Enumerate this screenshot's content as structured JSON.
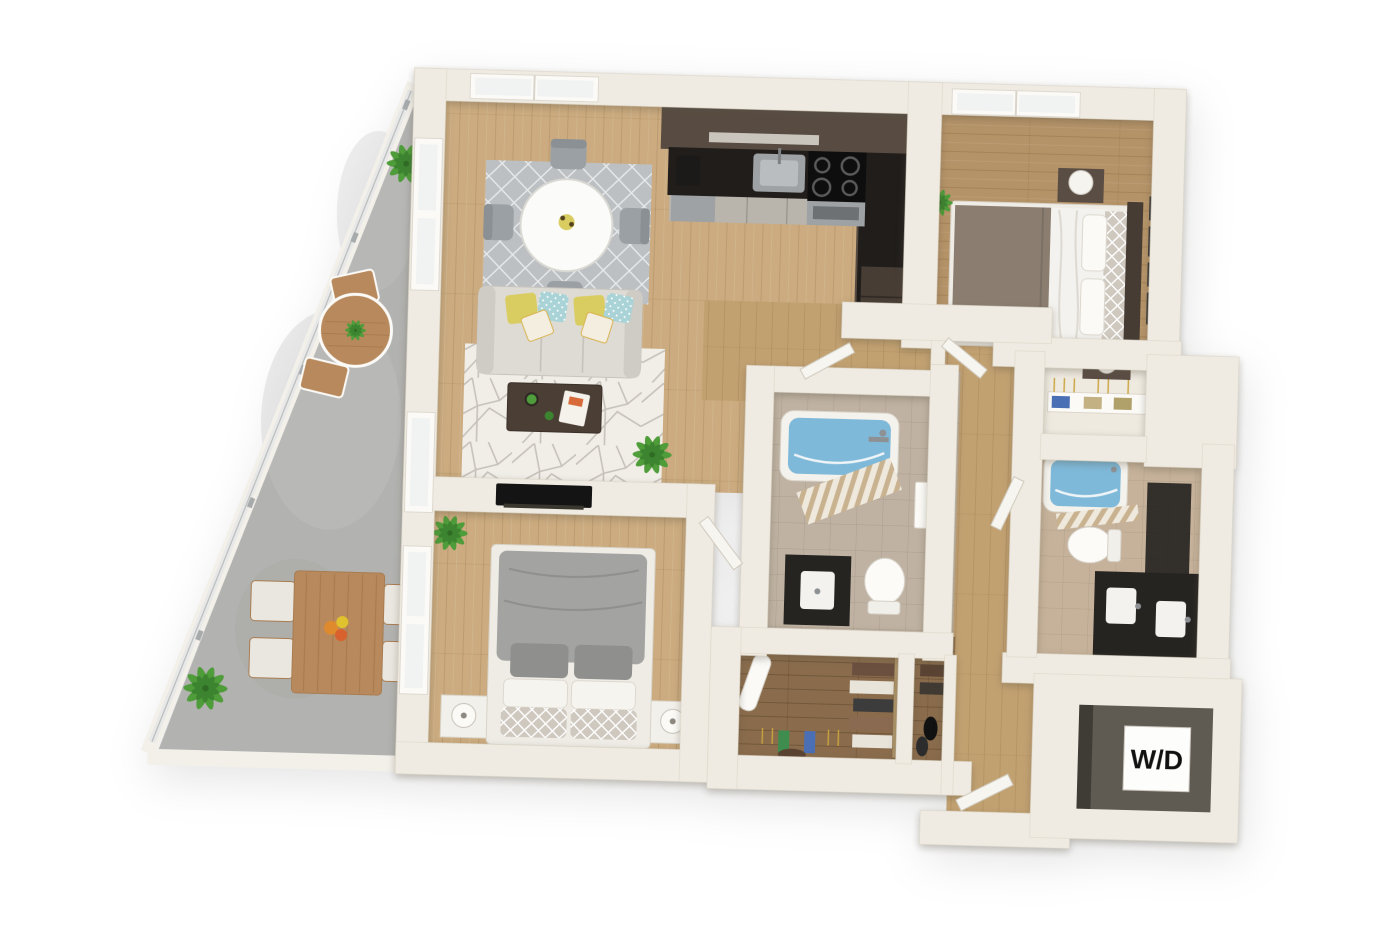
{
  "labels": {
    "washer_dryer": "W/D"
  },
  "colors": {
    "wall": "#f0ebe2",
    "wall_edge": "#ddd6c9",
    "wall_shade": "#d9d2c4",
    "door": "#f7f5f0",
    "floor_wood": "#cbab7f",
    "floor_wood_dark": "#b59368",
    "floor_hall": "#c2a171",
    "floor_closet": "#8a6c4c",
    "concrete": "#b2b2b0",
    "concrete_light": "#c4c4c2",
    "glass": "#e6e8e7",
    "tile1": "#bfb2a2",
    "tile2": "#c6b29a",
    "tub_blue": "#7fb9d9",
    "tub_blue_deep": "#5f9fc4",
    "cabinet_dark": "#584c42",
    "counter_black": "#201d1b",
    "cabinet_front": "#b9b4ac",
    "steel": "#9ea2a5",
    "vanity_dark": "#262421",
    "rug_gray": "#bcc0c3",
    "rug_white": "#f1eee8",
    "rug_line": "#c6c2ba",
    "sofa": "#dedbd4",
    "sofa_dark": "#cfccc5",
    "pillow_yellow": "#d9cd62",
    "pillow_teal": "#a9d3d6",
    "pillow_accent": "#f3eee0",
    "table_white": "#fbfbf9",
    "chair_gray": "#9aa0a4",
    "coffee_table": "#4a3e35",
    "tv_black": "#141414",
    "bed_gray": "#a3a3a1",
    "bed_gray_dark": "#8f8f8d",
    "bed_taupe": "#8b7e71",
    "sheet_white": "#f4f2ee",
    "headboard": "#463c33",
    "nightstand": "#f2f0ea",
    "nightstand_dark": "#5a4d44",
    "outdoor_wood": "#b8895c",
    "outdoor_wood_dark": "#a87c50",
    "cushion": "#eae7e0",
    "plant_green": "#4f9c3a",
    "plant_green_dark": "#3d8430",
    "curtain_tan": "#c9b290",
    "label_bg": "#fdfdfc",
    "label_text": "#111111",
    "frame_dark": "#3c3a38",
    "wd_void": "#5f5a52"
  }
}
